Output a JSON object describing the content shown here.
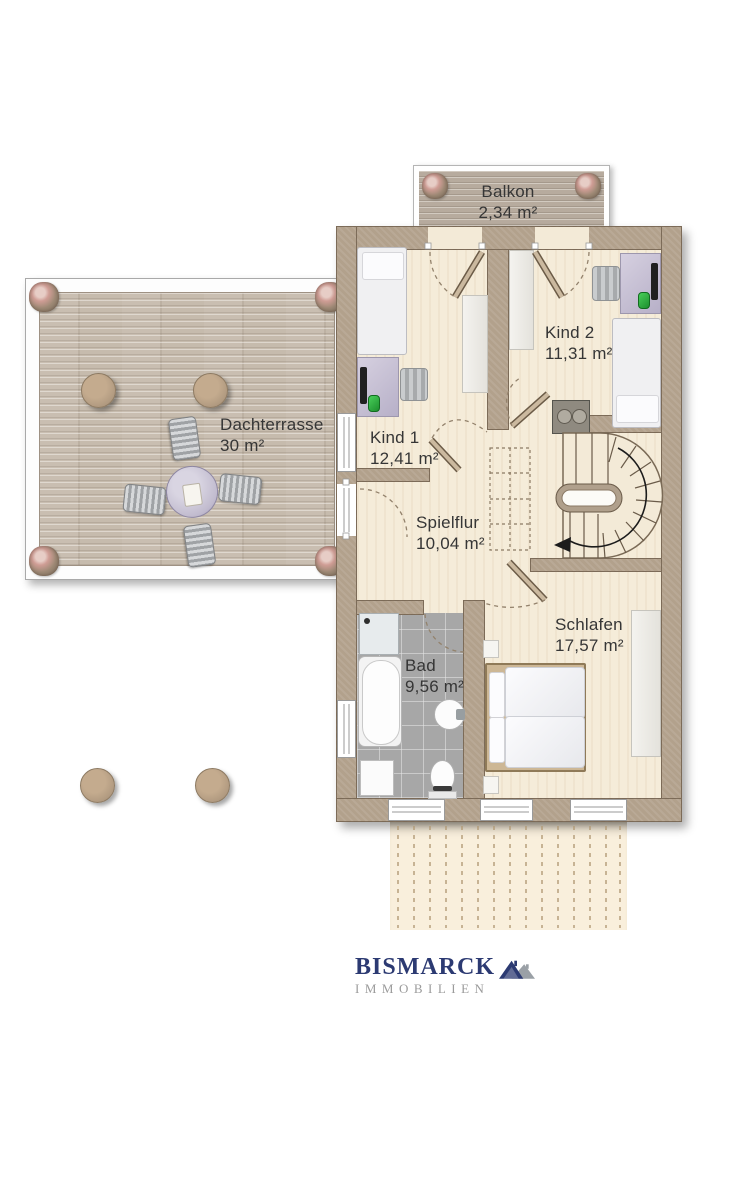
{
  "brand": {
    "title": "BISMARCK",
    "subtitle": "IMMOBILIEN"
  },
  "rooms": {
    "balkon": {
      "label": "Balkon",
      "area": "2,34 m²"
    },
    "kind2": {
      "label": "Kind 2",
      "area": "11,31 m²"
    },
    "kind1": {
      "label": "Kind 1",
      "area": "12,41 m²"
    },
    "dachterrasse": {
      "label": "Dachterrasse",
      "area": "30 m²"
    },
    "spielflur": {
      "label": "Spielflur",
      "area": "10,04 m²"
    },
    "schlafen": {
      "label": "Schlafen",
      "area": "17,57 m²"
    },
    "bad": {
      "label": "Bad",
      "area": "9,56 m²"
    }
  },
  "colors": {
    "wall": "#b2a18c",
    "floor": "#f5ecd9",
    "bath_tile": "#a7a7a7",
    "terrace_deck": "#c6bbad",
    "balcony_deck": "#b7ab9e",
    "logo_navy": "#2c3a72",
    "logo_gray": "#9b9b9b"
  },
  "icons": {
    "flower_pot": "flower-pot-icon",
    "logo_roofs": "bismarck-roofs-icon",
    "stair_arrow": "stairs-down-arrow-icon"
  }
}
